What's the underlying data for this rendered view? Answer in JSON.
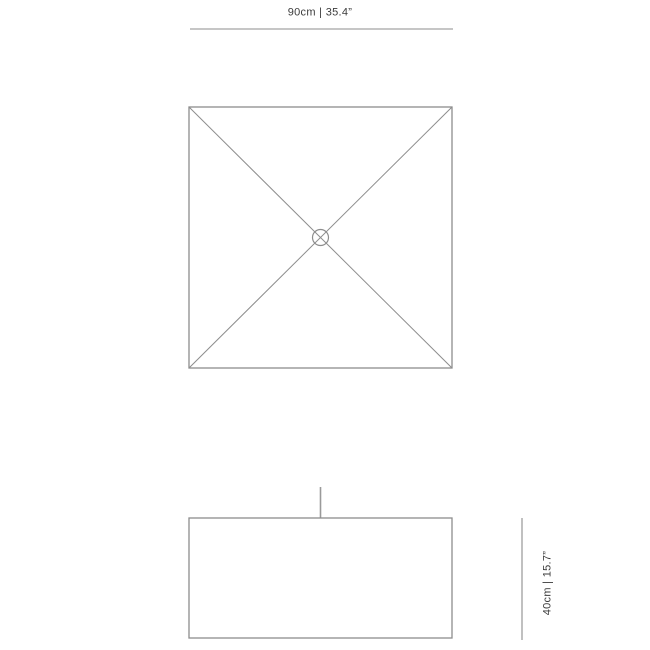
{
  "page": {
    "background_color": "#ffffff",
    "type": "product-dimension-diagram"
  },
  "colors": {
    "line": "#8d8d8d",
    "cord": "#9a9a9a",
    "text": "#3b3b3b"
  },
  "top_view": {
    "name": "top view - square shade with crossed diagonals and center canopy",
    "dimension_label": "90cm | 35.4”"
  },
  "front_view": {
    "name": "front view - rectangular shade with suspension cord",
    "dimension_label": "40cm | 15.7”"
  }
}
